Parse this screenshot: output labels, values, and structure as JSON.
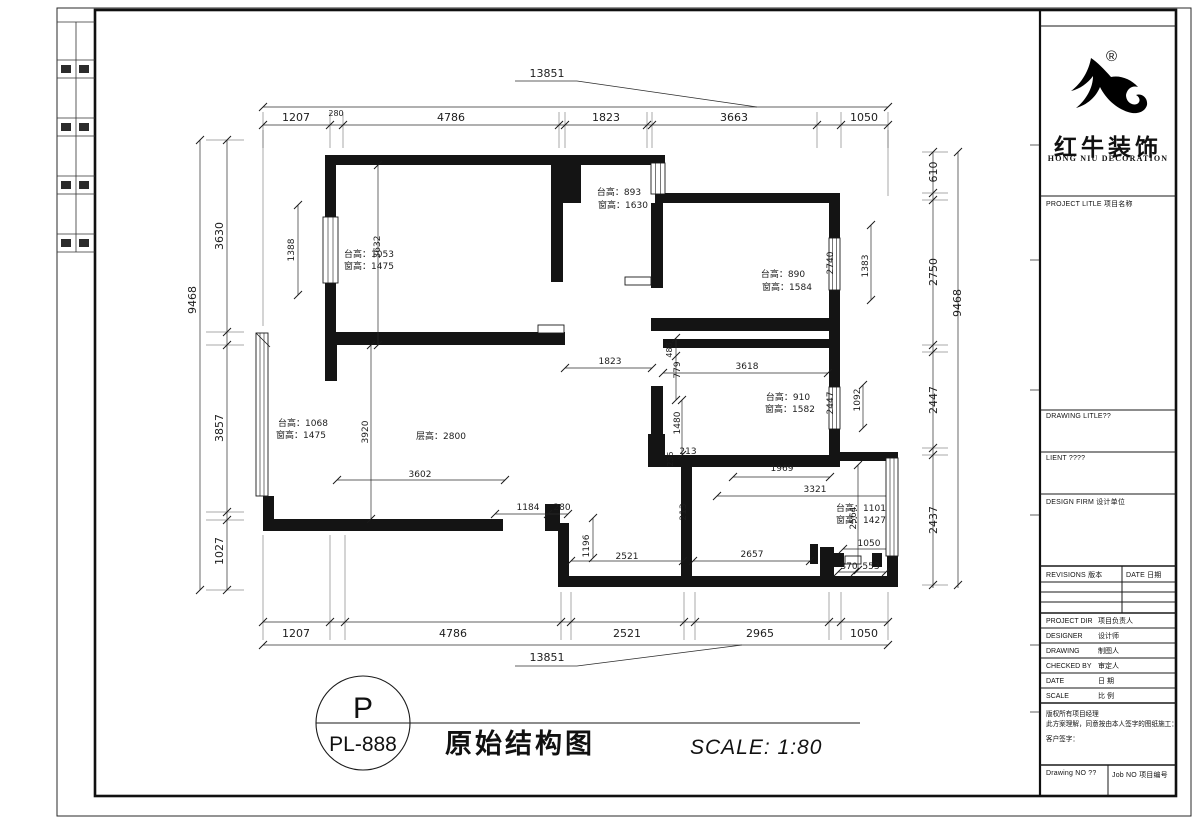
{
  "drawing": {
    "stamp": {
      "code_top": "P",
      "code_bottom": "PL-888"
    },
    "title": "原始结构图",
    "scale": "SCALE: 1:80",
    "labels": [
      {
        "t": "13851",
        "x": 547,
        "y": 77,
        "s": 11
      },
      {
        "t": "1207",
        "x": 296,
        "y": 121,
        "s": 11
      },
      {
        "t": "280",
        "x": 336,
        "y": 116,
        "s": 8
      },
      {
        "t": "4786",
        "x": 451,
        "y": 121,
        "s": 11
      },
      {
        "t": "1823",
        "x": 606,
        "y": 121,
        "s": 11
      },
      {
        "t": "3663",
        "x": 734,
        "y": 121,
        "s": 11
      },
      {
        "t": "1050",
        "x": 864,
        "y": 121,
        "s": 11
      },
      {
        "t": "1207",
        "x": 296,
        "y": 637,
        "s": 11
      },
      {
        "t": "4786",
        "x": 453,
        "y": 637,
        "s": 11
      },
      {
        "t": "2521",
        "x": 627,
        "y": 637,
        "s": 11
      },
      {
        "t": "2965",
        "x": 760,
        "y": 637,
        "s": 11
      },
      {
        "t": "1050",
        "x": 864,
        "y": 637,
        "s": 11
      },
      {
        "t": "13851",
        "x": 547,
        "y": 661,
        "s": 11
      },
      {
        "t": "9468",
        "x": 196,
        "y": 300,
        "r": -90,
        "s": 11
      },
      {
        "t": "3630",
        "x": 223,
        "y": 236,
        "r": -90,
        "s": 11
      },
      {
        "t": "3857",
        "x": 223,
        "y": 428,
        "r": -90,
        "s": 11
      },
      {
        "t": "1027",
        "x": 223,
        "y": 551,
        "r": -90,
        "s": 11
      },
      {
        "t": "610",
        "x": 937,
        "y": 172,
        "r": -90,
        "s": 11
      },
      {
        "t": "2750",
        "x": 937,
        "y": 272,
        "r": -90,
        "s": 11
      },
      {
        "t": "2447",
        "x": 937,
        "y": 400,
        "r": -90,
        "s": 11
      },
      {
        "t": "2437",
        "x": 937,
        "y": 520,
        "r": -90,
        "s": 11
      },
      {
        "t": "9468",
        "x": 961,
        "y": 303,
        "r": -90,
        "s": 11
      },
      {
        "t": "1388",
        "x": 294,
        "y": 250,
        "r": -90,
        "s": 9
      },
      {
        "t": "3632",
        "x": 380,
        "y": 247,
        "r": -90,
        "s": 9
      },
      {
        "t": "台高：1053",
        "x": 369,
        "y": 257,
        "s": 9,
        "n": "room-label"
      },
      {
        "t": "窗高：1475",
        "x": 369,
        "y": 269,
        "s": 9,
        "n": "room-label"
      },
      {
        "t": "台高：893",
        "x": 619,
        "y": 195,
        "s": 9,
        "n": "room-label"
      },
      {
        "t": "窗高：1630",
        "x": 623,
        "y": 208,
        "s": 9,
        "n": "room-label"
      },
      {
        "t": "台高：890",
        "x": 783,
        "y": 277,
        "s": 9,
        "n": "room-label"
      },
      {
        "t": "窗高：1584",
        "x": 787,
        "y": 290,
        "s": 9,
        "n": "room-label"
      },
      {
        "t": "2740",
        "x": 833,
        "y": 263,
        "r": -90,
        "s": 9
      },
      {
        "t": "1383",
        "x": 868,
        "y": 266,
        "r": -90,
        "s": 9
      },
      {
        "t": "1823",
        "x": 610,
        "y": 364,
        "s": 9
      },
      {
        "t": "488",
        "x": 672,
        "y": 350,
        "r": -90,
        "s": 8
      },
      {
        "t": "779",
        "x": 680,
        "y": 370,
        "r": -90,
        "s": 9
      },
      {
        "t": "3618",
        "x": 747,
        "y": 369,
        "s": 9
      },
      {
        "t": "台高：910",
        "x": 788,
        "y": 400,
        "s": 9,
        "n": "room-label"
      },
      {
        "t": "窗高：1582",
        "x": 790,
        "y": 412,
        "s": 9,
        "n": "room-label"
      },
      {
        "t": "2447",
        "x": 833,
        "y": 403,
        "r": -90,
        "s": 9
      },
      {
        "t": "1092",
        "x": 860,
        "y": 400,
        "r": -90,
        "s": 9
      },
      {
        "t": "1480",
        "x": 680,
        "y": 423,
        "r": -90,
        "s": 9
      },
      {
        "t": "213",
        "x": 688,
        "y": 454,
        "s": 9
      },
      {
        "t": "235",
        "x": 673,
        "y": 459,
        "r": -90,
        "s": 8
      },
      {
        "t": "台高：1068",
        "x": 303,
        "y": 426,
        "s": 9,
        "n": "room-label"
      },
      {
        "t": "窗高：1475",
        "x": 301,
        "y": 438,
        "s": 9,
        "n": "room-label"
      },
      {
        "t": "3920",
        "x": 368,
        "y": 432,
        "r": -90,
        "s": 9
      },
      {
        "t": "层高：2800",
        "x": 441,
        "y": 439,
        "s": 9,
        "n": "room-label"
      },
      {
        "t": "3602",
        "x": 420,
        "y": 477,
        "s": 9
      },
      {
        "t": "1969",
        "x": 782,
        "y": 471,
        "s": 9
      },
      {
        "t": "3321",
        "x": 815,
        "y": 492,
        "s": 9
      },
      {
        "t": "1184",
        "x": 528,
        "y": 510,
        "s": 9
      },
      {
        "t": "280",
        "x": 562,
        "y": 510,
        "s": 9
      },
      {
        "t": "1196",
        "x": 589,
        "y": 546,
        "r": -90,
        "s": 9
      },
      {
        "t": "2521",
        "x": 627,
        "y": 559,
        "s": 9
      },
      {
        "t": "213",
        "x": 686,
        "y": 512,
        "r": -90,
        "s": 9
      },
      {
        "t": "2657",
        "x": 752,
        "y": 557,
        "s": 9
      },
      {
        "t": "台高：1101",
        "x": 861,
        "y": 511,
        "s": 9,
        "n": "room-label"
      },
      {
        "t": "窗高：1427",
        "x": 861,
        "y": 523,
        "s": 9,
        "n": "room-label"
      },
      {
        "t": "2564",
        "x": 856,
        "y": 518,
        "r": -90,
        "s": 9
      },
      {
        "t": "1050",
        "x": 869,
        "y": 546,
        "s": 9
      },
      {
        "t": "370",
        "x": 849,
        "y": 569,
        "s": 9
      },
      {
        "t": "553",
        "x": 871,
        "y": 569,
        "s": 9
      }
    ]
  },
  "titleblock": {
    "brand": {
      "registered": "®",
      "name_cn": "红牛装饰",
      "name_en": "HONG NIU DECORATION"
    },
    "fields": {
      "project_title": "PROJECT LITLE 项目名称",
      "drawing_title": "DRAWING LITLE??",
      "client": "LIENT ????",
      "design_firm": "DESIGN FIRM 设计单位",
      "revisions": "REVISIONS 版本",
      "revisions_date": "DATE 日期",
      "staff_rows": [
        {
          "en": "PROJECT DIR",
          "cn": "项目负责人"
        },
        {
          "en": "DESIGNER",
          "cn": "设计师"
        },
        {
          "en": "DRAWING",
          "cn": "制图人"
        },
        {
          "en": "CHECKED BY",
          "cn": "审定人"
        },
        {
          "en": "DATE",
          "cn": "日 期"
        },
        {
          "en": "SCALE",
          "cn": "比 例"
        }
      ],
      "notes": [
        "版权所有项目经理",
        "此方案理解，同意按由本人签字的图纸施工：",
        "客户签字："
      ],
      "drawing_no": "Drawing NO ??",
      "job_no": "Job NO 项目编号"
    }
  }
}
